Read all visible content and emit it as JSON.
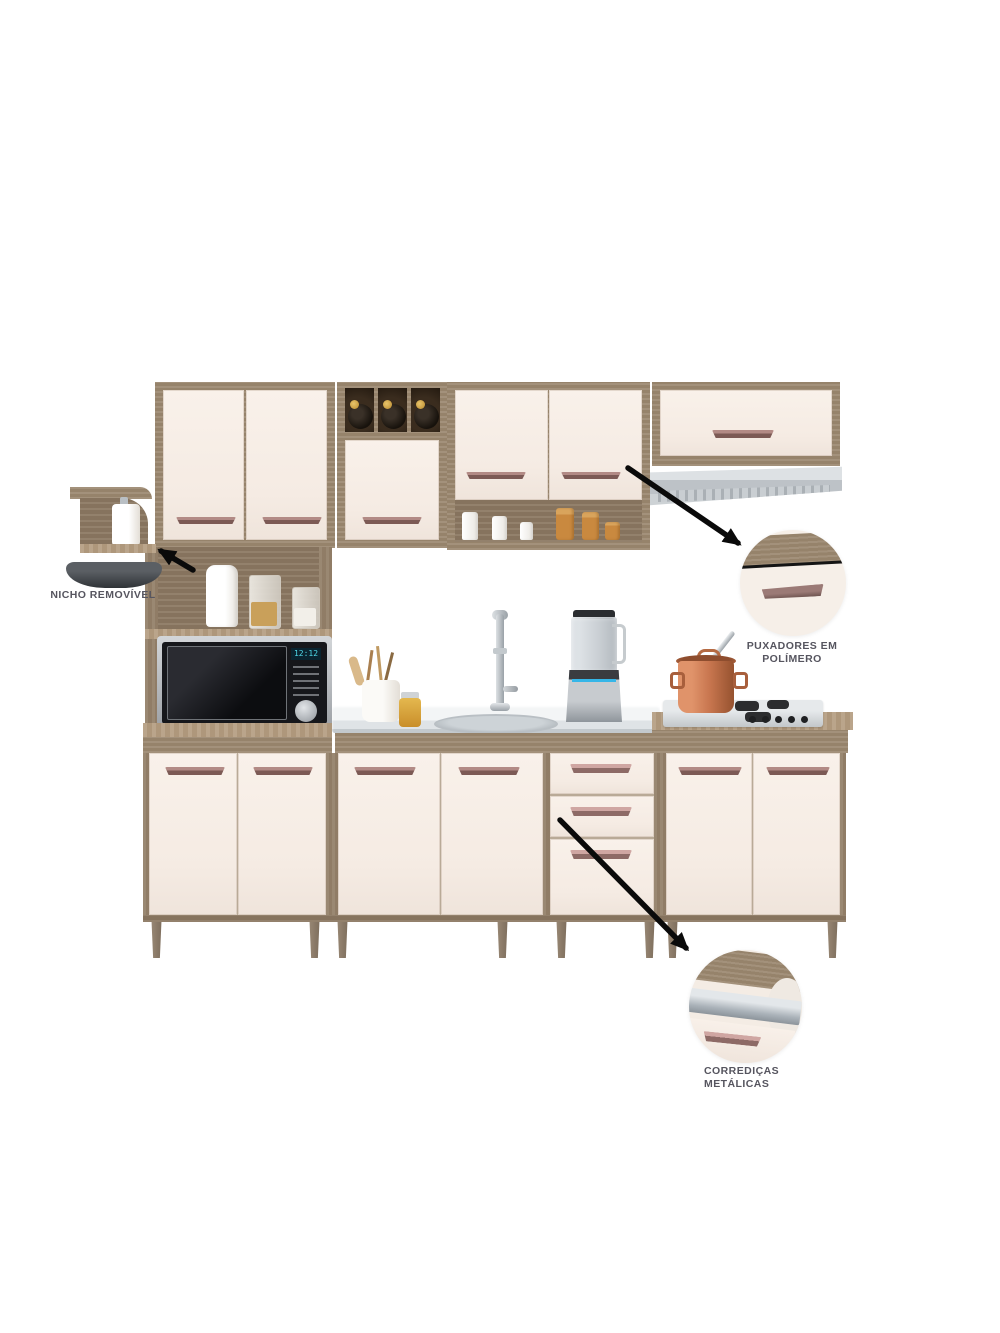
{
  "image_title": "modular kitchen cabinet set product image with feature callouts",
  "labels": {
    "niche": "NICHO REMOVÍVEL",
    "handles_line1": "PUXADORES EM",
    "handles_line2": "POLÍMERO",
    "slides_line1": "CORREDIÇAS",
    "slides_line2": "METÁLICAS"
  },
  "microwave": {
    "display": "12:12"
  },
  "colors": {
    "background": "#ffffff",
    "wood_frame": "#9c8971",
    "wood_dark": "#8d7a64",
    "counter_top": "#b49d81",
    "door_cream": "#f7efe7",
    "handle_polymer": "#8a6a66",
    "handle_pink": "#cfa6a2",
    "label_text": "#56555f",
    "arrow": "#0a0a0a",
    "steel": "#c9cdd1",
    "copper_pot": "#c97e57",
    "microwave_display": "#4fd8e8"
  },
  "scene_counts": {
    "wine_bottles": 3,
    "white_canisters": 3,
    "amber_jars": 3,
    "drawers": 3
  }
}
